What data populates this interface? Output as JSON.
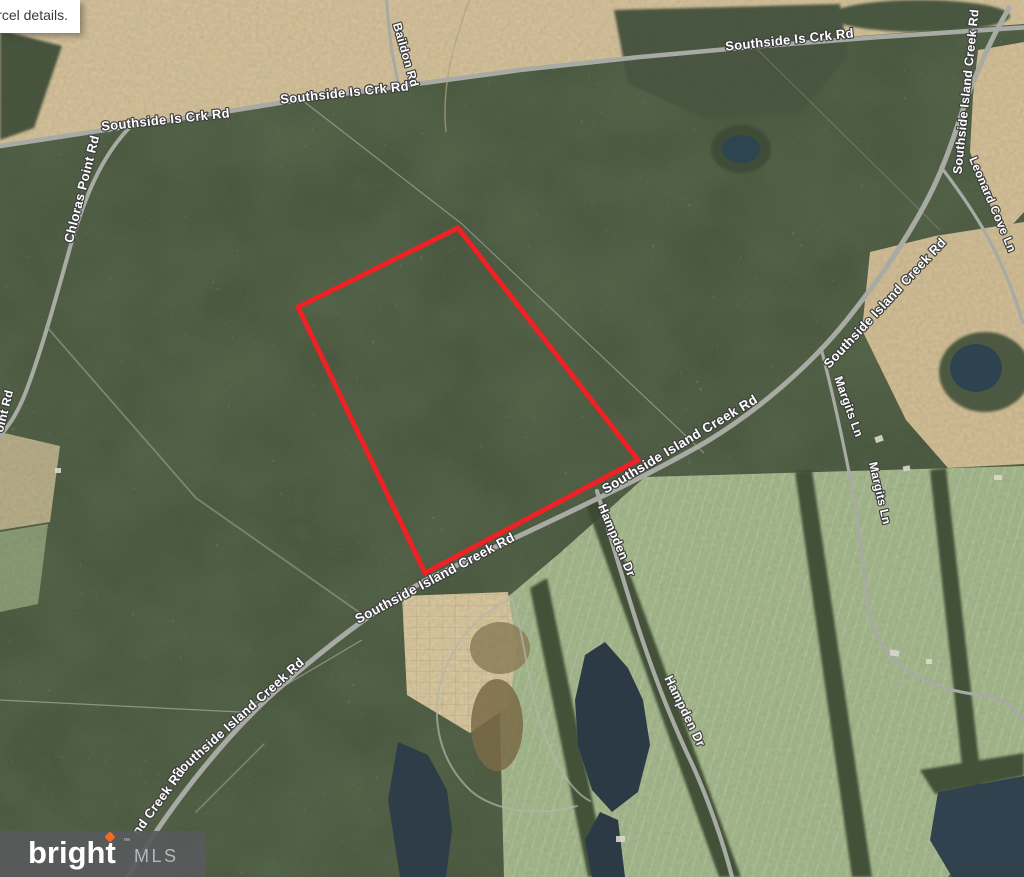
{
  "tooltip": {
    "text": "arcel details."
  },
  "logo": {
    "brand": "bright",
    "trademark": "™",
    "suffix": "MLS",
    "spark_color": "#f26a21",
    "background_color": "#58595b"
  },
  "map": {
    "type": "satellite-parcel-view",
    "parcel_outline_color": "#ef2125",
    "road_label_style": {
      "fill": "#ffffff",
      "outline": "#3d3d3d"
    },
    "road_labels": [
      {
        "text": "Southside Is Crk Rd",
        "x": 166,
        "y": 124,
        "rotate": -6
      },
      {
        "text": "Southside Is Crk Rd",
        "x": 345,
        "y": 97,
        "rotate": -6
      },
      {
        "text": "Southside Is Crk Rd",
        "x": 790,
        "y": 44,
        "rotate": -6
      },
      {
        "text": "Baildon Rd",
        "x": 402,
        "y": 56,
        "rotate": 74
      },
      {
        "text": "Chloras Point Rd",
        "x": 86,
        "y": 190,
        "rotate": -76
      },
      {
        "text": "oint Rd",
        "x": 8,
        "y": 412,
        "rotate": -76
      },
      {
        "text": "Southside Island Creek Rd",
        "x": 970,
        "y": 92,
        "rotate": -84
      },
      {
        "text": "Leonard Cove Ln",
        "x": 989,
        "y": 206,
        "rotate": 67
      },
      {
        "text": "Southside Island Creek Rd",
        "x": 888,
        "y": 306,
        "rotate": -47
      },
      {
        "text": "Margits Ln",
        "x": 845,
        "y": 408,
        "rotate": 70
      },
      {
        "text": "Margits Ln",
        "x": 876,
        "y": 494,
        "rotate": 77
      },
      {
        "text": "Southside Island Creek Rd",
        "x": 682,
        "y": 448,
        "rotate": -31
      },
      {
        "text": "Southside Island Creek Rd",
        "x": 437,
        "y": 582,
        "rotate": -28
      },
      {
        "text": "Hampden Dr",
        "x": 613,
        "y": 542,
        "rotate": 67
      },
      {
        "text": "Hampden Dr",
        "x": 681,
        "y": 713,
        "rotate": 64
      },
      {
        "text": "Southside Island Creek Rd",
        "x": 241,
        "y": 721,
        "rotate": -42
      },
      {
        "text": "nd Creek Rd",
        "x": 162,
        "y": 804,
        "rotate": -54
      }
    ]
  }
}
